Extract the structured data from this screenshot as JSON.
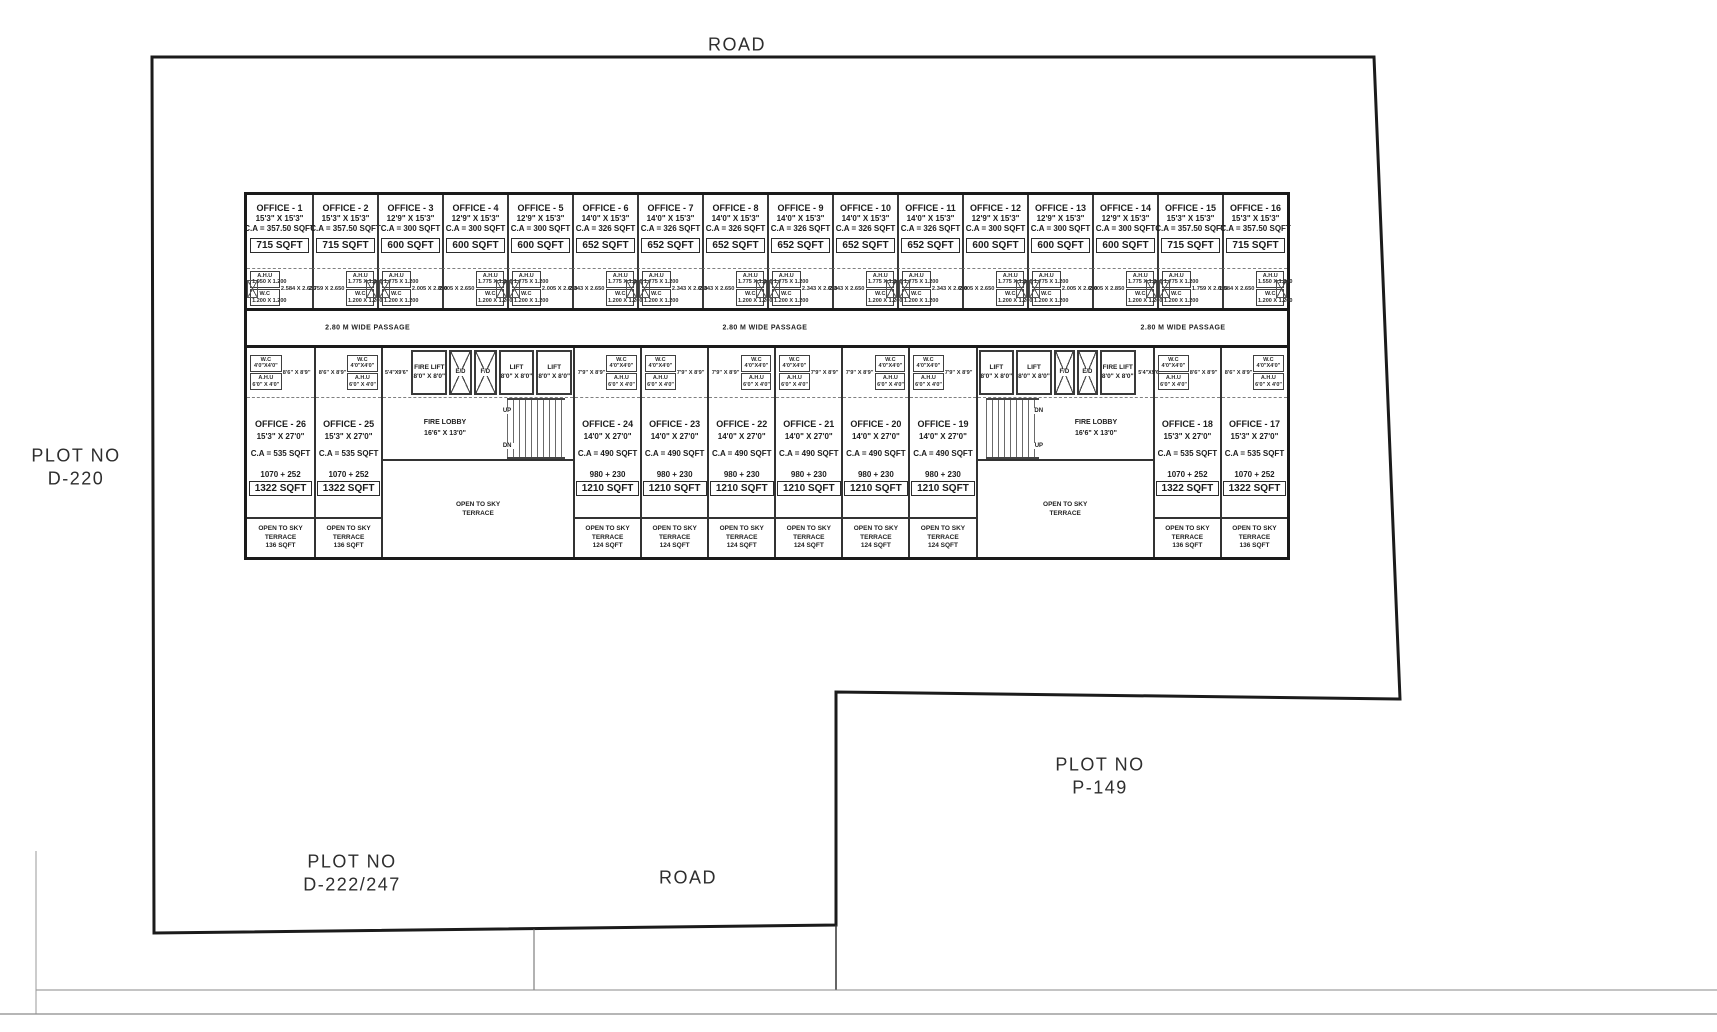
{
  "page": {
    "road_top": "ROAD",
    "road_bottom": "ROAD",
    "plot_left": {
      "line1": "PLOT NO",
      "line2": "D-220"
    },
    "plot_right": {
      "line1": "PLOT NO",
      "line2": "P-149"
    },
    "plot_bottom": {
      "line1": "PLOT NO",
      "line2": "D-222/247"
    },
    "passage_label": "2.80 M  WIDE PASSAGE"
  },
  "service_labels": {
    "ahu": "A.H.U",
    "wc": "W.C",
    "wc_dim_top": "1.200 X 1.200",
    "wc_dim_bottom": "4'0\"X4'0\"",
    "ahu_dim_bottom": "6'0\" X 4'0\""
  },
  "terrace_labels": {
    "line1": "OPEN TO SKY",
    "line2": "TERRACE"
  },
  "top_offices": [
    {
      "name": "OFFICE - 1",
      "size": "15'3\" X 15'3\"",
      "ca": "C.A = 357.50 SQFT",
      "area": "715 SQFT",
      "ahu_dim": "1.950 X 1.200",
      "open_dim": "2.584 X 2.650"
    },
    {
      "name": "OFFICE - 2",
      "size": "15'3\" X 15'3\"",
      "ca": "C.A = 357.50 SQFT",
      "area": "715 SQFT",
      "ahu_dim": "1.775 X 1.200",
      "open_dim": "2.759 X 2.650"
    },
    {
      "name": "OFFICE - 3",
      "size": "12'9\" X 15'3\"",
      "ca": "C.A = 300 SQFT",
      "area": "600 SQFT",
      "ahu_dim": "1.775 X 1.200",
      "open_dim": "2.005 X 2.850"
    },
    {
      "name": "OFFICE - 4",
      "size": "12'9\" X 15'3\"",
      "ca": "C.A = 300 SQFT",
      "area": "600 SQFT",
      "ahu_dim": "1.775 X 1.200",
      "open_dim": "2.005 X 2.650"
    },
    {
      "name": "OFFICE - 5",
      "size": "12'9\" X 15'3\"",
      "ca": "C.A = 300 SQFT",
      "area": "600 SQFT",
      "ahu_dim": "1.775 X 1.200",
      "open_dim": "2.005 X 2.650"
    },
    {
      "name": "OFFICE - 6",
      "size": "14'0\" X 15'3\"",
      "ca": "C.A = 326 SQFT",
      "area": "652 SQFT",
      "ahu_dim": "1.775 X 1.200",
      "open_dim": "2.343 X 2.650"
    },
    {
      "name": "OFFICE - 7",
      "size": "14'0\" X 15'3\"",
      "ca": "C.A = 326 SQFT",
      "area": "652 SQFT",
      "ahu_dim": "1.775 X 1.200",
      "open_dim": "2.343 X 2.650"
    },
    {
      "name": "OFFICE - 8",
      "size": "14'0\" X 15'3\"",
      "ca": "C.A = 326 SQFT",
      "area": "652 SQFT",
      "ahu_dim": "1.775 X 1.200",
      "open_dim": "2.343 X 2.650"
    },
    {
      "name": "OFFICE - 9",
      "size": "14'0\" X 15'3\"",
      "ca": "C.A = 326 SQFT",
      "area": "652 SQFT",
      "ahu_dim": "1.775 X 1.200",
      "open_dim": "2.343 X 2.650"
    },
    {
      "name": "OFFICE - 10",
      "size": "14'0\" X 15'3\"",
      "ca": "C.A = 326 SQFT",
      "area": "652 SQFT",
      "ahu_dim": "1.775 X 1.200",
      "open_dim": "2.343 X 2.650"
    },
    {
      "name": "OFFICE - 11",
      "size": "14'0\" X 15'3\"",
      "ca": "C.A = 326 SQFT",
      "area": "652 SQFT",
      "ahu_dim": "1.775 X 1.200",
      "open_dim": "2.343 X 2.650"
    },
    {
      "name": "OFFICE - 12",
      "size": "12'9\" X 15'3\"",
      "ca": "C.A = 300 SQFT",
      "area": "600 SQFT",
      "ahu_dim": "1.775 X 1.200",
      "open_dim": "2.005 X 2.650"
    },
    {
      "name": "OFFICE - 13",
      "size": "12'9\" X 15'3\"",
      "ca": "C.A = 300 SQFT",
      "area": "600 SQFT",
      "ahu_dim": "1.775 X 1.200",
      "open_dim": "2.005 X 2.650"
    },
    {
      "name": "OFFICE - 14",
      "size": "12'9\" X 15'3\"",
      "ca": "C.A = 300 SQFT",
      "area": "600 SQFT",
      "ahu_dim": "1.775 X 1.200",
      "open_dim": "2.005 X 2.850"
    },
    {
      "name": "OFFICE - 15",
      "size": "15'3\" X 15'3\"",
      "ca": "C.A = 357.50 SQFT",
      "area": "715 SQFT",
      "ahu_dim": "1.775 X 1.200",
      "open_dim": "1.759 X 2.650"
    },
    {
      "name": "OFFICE - 16",
      "size": "15'3\" X 15'3\"",
      "ca": "C.A = 357.50 SQFT",
      "area": "715 SQFT",
      "ahu_dim": "1.550 X 1.200",
      "open_dim": "1.584 X 2.650"
    }
  ],
  "bottom_left_offices": [
    {
      "name": "OFFICE - 26",
      "size": "15'3\" X 27'0\"",
      "ca": "C.A = 535 SQFT",
      "split": "1070 + 252",
      "area": "1322 SQFT",
      "room_dim": "8'6\" X 8'9\"",
      "terrace_area": "136 SQFT"
    },
    {
      "name": "OFFICE - 25",
      "size": "15'3\" X 27'0\"",
      "ca": "C.A = 535 SQFT",
      "split": "1070 + 252",
      "area": "1322 SQFT",
      "room_dim": "8'6\" X 8'9\"",
      "terrace_area": "136 SQFT"
    }
  ],
  "bottom_mid_offices": [
    {
      "name": "OFFICE - 24",
      "size": "14'0\" X 27'0\"",
      "ca": "C.A = 490 SQFT",
      "split": "980 + 230",
      "area": "1210 SQFT",
      "room_dim": "7'9\" X 8'9\"",
      "terrace_area": "124 SQFT"
    },
    {
      "name": "OFFICE - 23",
      "size": "14'0\" X 27'0\"",
      "ca": "C.A = 490 SQFT",
      "split": "980 + 230",
      "area": "1210 SQFT",
      "room_dim": "7'9\" X 8'9\"",
      "terrace_area": "124 SQFT"
    },
    {
      "name": "OFFICE - 22",
      "size": "14'0\" X 27'0\"",
      "ca": "C.A = 490 SQFT",
      "split": "980 + 230",
      "area": "1210 SQFT",
      "room_dim": "7'9\" X 8'9\"",
      "terrace_area": "124 SQFT"
    },
    {
      "name": "OFFICE - 21",
      "size": "14'0\" X 27'0\"",
      "ca": "C.A = 490 SQFT",
      "split": "980 + 230",
      "area": "1210 SQFT",
      "room_dim": "7'9\" X 8'9\"",
      "terrace_area": "124 SQFT"
    },
    {
      "name": "OFFICE - 20",
      "size": "14'0\" X 27'0\"",
      "ca": "C.A = 490 SQFT",
      "split": "980 + 230",
      "area": "1210 SQFT",
      "room_dim": "7'9\" X 8'9\"",
      "terrace_area": "124 SQFT"
    },
    {
      "name": "OFFICE - 19",
      "size": "14'0\" X 27'0\"",
      "ca": "C.A = 490 SQFT",
      "split": "980 + 230",
      "area": "1210 SQFT",
      "room_dim": "7'9\" X 8'9\"",
      "terrace_area": "124 SQFT"
    }
  ],
  "bottom_right_offices": [
    {
      "name": "OFFICE - 18",
      "size": "15'3\" X 27'0\"",
      "ca": "C.A = 535 SQFT",
      "split": "1070 + 252",
      "area": "1322 SQFT",
      "room_dim": "8'6\" X 8'9\"",
      "terrace_area": "136 SQFT"
    },
    {
      "name": "OFFICE - 17",
      "size": "15'3\" X 27'0\"",
      "ca": "C.A = 535 SQFT",
      "split": "1070 + 252",
      "area": "1322 SQFT",
      "room_dim": "8'6\" X 8'9\"",
      "terrace_area": "136 SQFT"
    }
  ],
  "lobby_left": {
    "side_dim": "5'4\"X9'6\"",
    "shafts": [
      {
        "label": "FIRE LIFT",
        "dim": "8'0\" X 8'0\""
      },
      {
        "label": "E/D"
      },
      {
        "label": "F/D"
      },
      {
        "label": "LIFT",
        "dim": "8'0\" X 8'0\""
      },
      {
        "label": "LIFT",
        "dim": "8'0\" X 8'0\""
      }
    ],
    "lobby_name": "FIRE  LOBBY",
    "lobby_dim": "16'6\" X 13'0\"",
    "up": "UP",
    "dn": "DN"
  },
  "lobby_right": {
    "side_dim": "5'4\"X9'6\"",
    "shafts": [
      {
        "label": "LIFT",
        "dim": "8'0\" X 8'0\""
      },
      {
        "label": "LIFT",
        "dim": "8'0\" X 8'0\""
      },
      {
        "label": "F/D"
      },
      {
        "label": "E/D"
      },
      {
        "label": "FIRE LIFT",
        "dim": "8'0\" X 8'0\""
      }
    ],
    "lobby_name": "FIRE  LOBBY",
    "lobby_dim": "16'6\" X 13'0\"",
    "dn": "DN",
    "up": "UP"
  }
}
